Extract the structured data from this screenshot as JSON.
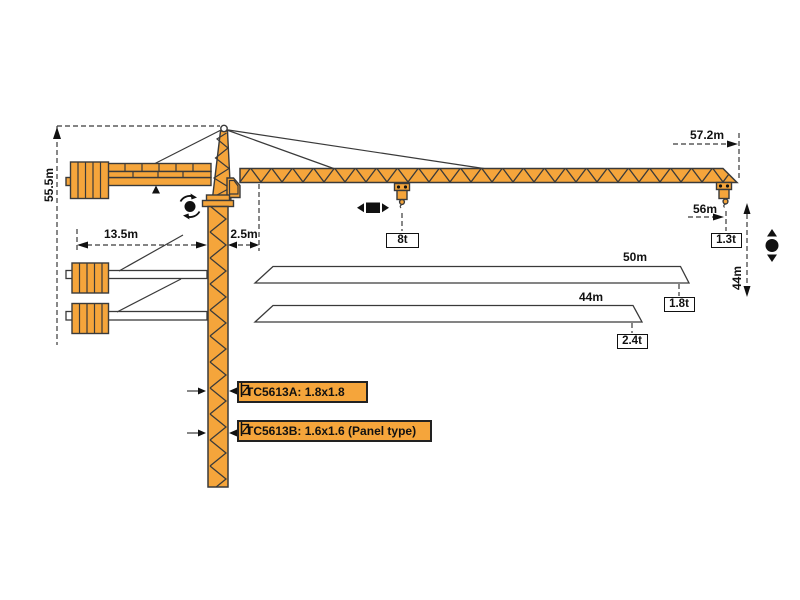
{
  "meta": {
    "title": "TC5613 tower crane dimension and load diagram"
  },
  "colors": {
    "crane_orange": "#F5A53B",
    "line_dark": "#3a3a3a",
    "black": "#111111",
    "paper": "#ffffff"
  },
  "dimension_labels": {
    "tower_height": "55.5m",
    "counterjib_length": "13.5m",
    "jib_foot_offset": "2.5m",
    "max_radius": "57.2m",
    "hook_radius": "56m",
    "hoist_height": "44m"
  },
  "load_labels": {
    "mid_span_load": "8t",
    "tip_load_56m": "1.3t",
    "tip_load_50m": "1.8t",
    "tip_load_44m": "2.4t"
  },
  "jib_option_labels": {
    "jib_50": "50m",
    "jib_44": "44m"
  },
  "model_labels": {
    "model_a": "TC5613A: 1.8x1.8",
    "model_b": "TC5613B: 1.6x1.6 (Panel type)"
  },
  "icons": {
    "rotation_icon": "black circle with curved slewing arrows",
    "trolley_travel_icon": "black square with left/right triangles",
    "hoist_icon": "black circle with up/down triangles",
    "mast_section_icon": "square mast cross-section glyph"
  },
  "configurations": [
    {
      "jib_length": "57.2m (hook 56m)",
      "tip_load": "1.3t",
      "mid_load_at_trolley": "8t"
    },
    {
      "jib_length": "50m",
      "tip_load": "1.8t"
    },
    {
      "jib_length": "44m",
      "tip_load": "2.4t"
    }
  ]
}
